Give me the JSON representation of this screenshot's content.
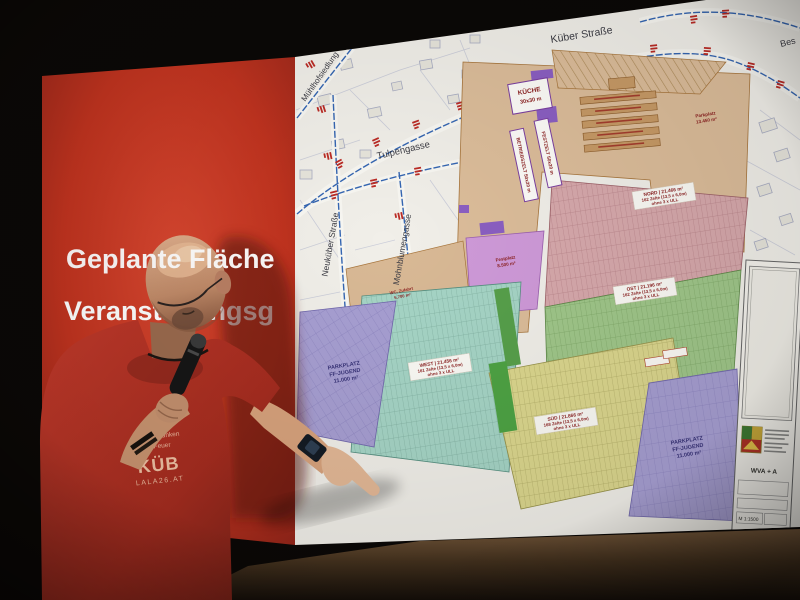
{
  "slide": {
    "line1": "Geplante Fläche",
    "line2": "Veranstaltungsg"
  },
  "tshirt": {
    "line1": "Tausend Funken",
    "line2": "Ein Feuer",
    "brand": "KÜB",
    "website": "LALA26.AT"
  },
  "map": {
    "streets": {
      "kueber": "Küber Straße",
      "tulpen": "Tulpengasse",
      "mohnblumen": "Mohnblumengasse",
      "neukueber": "Neuküber Straße",
      "muehlhof": "Mühlhofsiedlung",
      "bes": "Bes"
    },
    "zone_labels": {
      "nord": {
        "l1": "NORD | 21.466 m²",
        "l2": "162 Zelte (13,5 x 6,0m)",
        "l3": "ohne 3 x ULL"
      },
      "ost": {
        "l1": "OST | 21.196 m²",
        "l2": "162 Zelte (13,5 x 6,0m)",
        "l3": "ohne 3 x ULL"
      },
      "west": {
        "l1": "WEST | 21.456 m²",
        "l2": "161 Zelte (13,5 x 6,0m)",
        "l3": "ohne 3 x ULL"
      },
      "sued": {
        "l1": "SÜD | 21.866 m²",
        "l2": "168 Zelte (13,5 x 6,0m)",
        "l3": "ohne 3 x ULL"
      }
    },
    "site_labels": {
      "kueche1": "KÜCHE",
      "kueche2": "30x30 m",
      "zelt1": "BETRIEBSZELT 50x20 m",
      "zelt2": "FESTZELT 50x20 m",
      "festplatz1": "Festplatz",
      "festplatz2": "8.500 m²",
      "wc1": "WC, Zufahrt",
      "wc2": "5.700 m²",
      "parkplatz_ost1": "Parkplatz",
      "parkplatz_ost2": "13.450 m²"
    },
    "parking_left": {
      "l1": "PARKPLATZ",
      "l2": "FF-JUGEND",
      "l3": "11.000 m²"
    },
    "parking_right": {
      "l1": "PARKPLATZ",
      "l2": "FF-JUGEND",
      "l3": "11.000 m²"
    },
    "titleblock": {
      "title": "WVA + A",
      "scale": "M 1:1500"
    }
  },
  "colors": {
    "slide_red": "#c6392a",
    "zone_pink": "#d7a9ac",
    "zone_green": "#a0c78a",
    "zone_teal": "#a6d5c6",
    "zone_yellow": "#dcd78e",
    "zone_purple": "#a79fd2",
    "zone_violet": "#cf9ad9",
    "label_red": "#8b1f1f"
  }
}
